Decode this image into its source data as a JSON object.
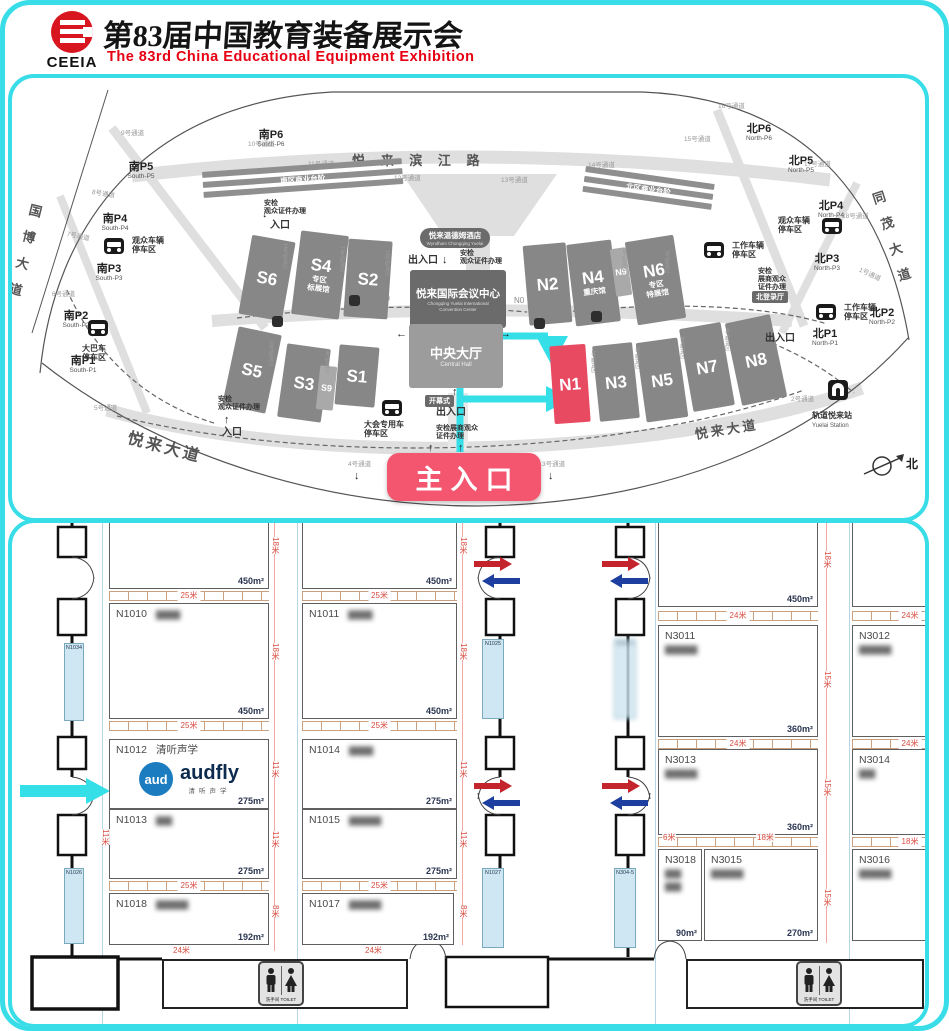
{
  "header": {
    "logo": "CEEIA",
    "title_cn": "第83届中国教育装备展示会",
    "title_en": "The 83rd China  Educational  Equipment  Exhibition"
  },
  "map": {
    "main_entrance": "主入口",
    "compass": "北",
    "center": {
      "hotel": "悦来温德姆酒店",
      "hotel_en": "Wyndham Chongqing Yuelai",
      "conv": "悦来国际会议中心",
      "conv_en": "Chongqing Yuelai International\nConvention Center",
      "hall": "中央大厅",
      "hall_en": "Central Hall"
    },
    "halls": [
      {
        "id": "S6",
        "x": 233,
        "y": 160,
        "w": 44,
        "h": 80,
        "r": 10
      },
      {
        "id": "S4",
        "x": 284,
        "y": 155,
        "w": 48,
        "h": 84,
        "r": 7,
        "sub": "专区\n标展馆"
      },
      {
        "id": "S2",
        "x": 334,
        "y": 162,
        "w": 44,
        "h": 78,
        "r": 4
      },
      {
        "id": "S5",
        "x": 218,
        "y": 252,
        "w": 44,
        "h": 80,
        "r": 12
      },
      {
        "id": "S3",
        "x": 270,
        "y": 268,
        "w": 44,
        "h": 74,
        "r": 8
      },
      {
        "id": "S9",
        "x": 306,
        "y": 288,
        "w": 17,
        "h": 44,
        "r": 6,
        "sm": 1
      },
      {
        "id": "S1",
        "x": 325,
        "y": 268,
        "w": 40,
        "h": 60,
        "r": 5
      },
      {
        "id": "N2",
        "x": 514,
        "y": 166,
        "w": 43,
        "h": 80,
        "r": -5
      },
      {
        "id": "N4",
        "x": 559,
        "y": 164,
        "w": 45,
        "h": 82,
        "r": -7,
        "sub": "重庆馆"
      },
      {
        "id": "N9",
        "x": 601,
        "y": 170,
        "w": 16,
        "h": 48,
        "r": -8,
        "sm": 1
      },
      {
        "id": "N6",
        "x": 619,
        "y": 160,
        "w": 49,
        "h": 84,
        "r": -9,
        "sub": "专区\n特展馆"
      },
      {
        "id": "N1",
        "x": 540,
        "y": 267,
        "w": 36,
        "h": 78,
        "r": -4,
        "hl": 1
      },
      {
        "id": "N3",
        "x": 584,
        "y": 266,
        "w": 40,
        "h": 76,
        "r": -6
      },
      {
        "id": "N5",
        "x": 629,
        "y": 262,
        "w": 42,
        "h": 80,
        "r": -8
      },
      {
        "id": "N7",
        "x": 674,
        "y": 247,
        "w": 42,
        "h": 84,
        "r": -10
      },
      {
        "id": "N8",
        "x": 721,
        "y": 240,
        "w": 46,
        "h": 84,
        "r": -12
      }
    ],
    "parkings": [
      {
        "cn": "南P6",
        "en": "South-P6",
        "x": 236,
        "y": 52
      },
      {
        "cn": "南P5",
        "en": "South-P5",
        "x": 106,
        "y": 84
      },
      {
        "cn": "南P4",
        "en": "South-P4",
        "x": 80,
        "y": 136
      },
      {
        "cn": "南P3",
        "en": "South-P3",
        "x": 74,
        "y": 186
      },
      {
        "cn": "南P2",
        "en": "South-P2",
        "x": 41,
        "y": 233
      },
      {
        "cn": "南P1",
        "en": "South-P1",
        "x": 48,
        "y": 278
      },
      {
        "cn": "北P6",
        "en": "North-P6",
        "x": 724,
        "y": 46
      },
      {
        "cn": "北P5",
        "en": "North-P5",
        "x": 766,
        "y": 78
      },
      {
        "cn": "北P4",
        "en": "North-P4",
        "x": 796,
        "y": 123
      },
      {
        "cn": "北P3",
        "en": "North-P3",
        "x": 792,
        "y": 176
      },
      {
        "cn": "北P2",
        "en": "North-P2",
        "x": 847,
        "y": 230
      },
      {
        "cn": "北P1",
        "en": "North-P1",
        "x": 790,
        "y": 251
      }
    ],
    "channels": [
      {
        "t": "9号通道",
        "x": 109,
        "y": 49
      },
      {
        "t": "10号通道",
        "x": 236,
        "y": 60
      },
      {
        "t": "11号通道",
        "x": 296,
        "y": 80
      },
      {
        "t": "12号通道",
        "x": 382,
        "y": 94
      },
      {
        "t": "13号通道",
        "x": 489,
        "y": 96
      },
      {
        "t": "14号通道",
        "x": 576,
        "y": 81
      },
      {
        "t": "15号通道",
        "x": 672,
        "y": 55
      },
      {
        "t": "16号通道",
        "x": 706,
        "y": 22
      },
      {
        "t": "17号通道",
        "x": 792,
        "y": 80
      },
      {
        "t": "18号通道",
        "x": 830,
        "y": 132
      },
      {
        "t": "1号通道",
        "x": 850,
        "y": 186,
        "r": 25
      },
      {
        "t": "2号通道",
        "x": 779,
        "y": 315
      },
      {
        "t": "3号通道",
        "x": 530,
        "y": 380
      },
      {
        "t": "4号通道",
        "x": 336,
        "y": 380
      },
      {
        "t": "5号通道",
        "x": 82,
        "y": 324
      },
      {
        "t": "6号通道",
        "x": 40,
        "y": 210
      },
      {
        "t": "7号通道",
        "x": 56,
        "y": 150,
        "r": 12
      },
      {
        "t": "8号通道",
        "x": 81,
        "y": 108,
        "r": 10
      }
    ],
    "unloads": [
      {
        "t": "14号卸货区",
        "x": 270,
        "y": 165
      },
      {
        "t": "13号卸货区",
        "x": 327,
        "y": 168
      },
      {
        "t": "12号卸货区",
        "x": 372,
        "y": 172
      },
      {
        "t": "10号卸货区",
        "x": 256,
        "y": 262
      },
      {
        "t": "9号卸货区",
        "x": 312,
        "y": 272
      },
      {
        "t": "5号卸货区",
        "x": 609,
        "y": 170
      },
      {
        "t": "7号卸货区",
        "x": 652,
        "y": 172
      },
      {
        "t": "1号卸货区",
        "x": 578,
        "y": 272
      },
      {
        "t": "2号卸货区",
        "x": 622,
        "y": 268
      },
      {
        "t": "3号卸货区",
        "x": 667,
        "y": 258
      },
      {
        "t": "4号卸货区",
        "x": 712,
        "y": 250
      }
    ],
    "texts": [
      {
        "t": "悦 来 滨 江 路",
        "x": 340,
        "y": 76,
        "cls": "s13 bold roadlbl sp6",
        "name": "road-yuelai-binjiang"
      },
      {
        "t": "国博大道",
        "x": 16,
        "y": 124,
        "cls": "s13 bold roadlbl vert",
        "r": 14,
        "name": "road-guobo-avenue"
      },
      {
        "t": "同茂大道",
        "x": 856,
        "y": 116,
        "cls": "s13 bold roadlbl vert",
        "r": -18,
        "name": "road-tongmao-avenue"
      },
      {
        "t": "悦来大道",
        "x": 118,
        "y": 352,
        "cls": "s16 bold roadlbl sp3",
        "r": 15,
        "name": "road-yuelai-avenue-west"
      },
      {
        "t": "悦来大道",
        "x": 682,
        "y": 350,
        "cls": "s13 bold roadlbl sp3",
        "r": -9,
        "name": "road-yuelai-avenue-east"
      },
      {
        "t": "出入口",
        "x": 396,
        "y": 177,
        "cls": "s10 bold",
        "name": "gate-label"
      },
      {
        "t": "安检\n观众证件办理",
        "x": 448,
        "y": 172,
        "cls": "s7 bold",
        "name": "security-label"
      },
      {
        "t": "出入口",
        "x": 424,
        "y": 329,
        "cls": "s10 bold",
        "name": "gate-label"
      },
      {
        "t": "安检展商观众\n证件办理",
        "x": 424,
        "y": 347,
        "cls": "s7 bold",
        "name": "security-label"
      },
      {
        "t": "安检\n观众证件办理",
        "x": 252,
        "y": 122,
        "cls": "s7 bold",
        "name": "security-label"
      },
      {
        "t": "入口",
        "x": 258,
        "y": 142,
        "cls": "s10 bold",
        "name": "entrance-label"
      },
      {
        "t": "安检\n观众证件办理",
        "x": 206,
        "y": 318,
        "cls": "s7 bold",
        "name": "security-label"
      },
      {
        "t": "入口",
        "x": 210,
        "y": 349,
        "cls": "s10 bold",
        "name": "entrance-label"
      },
      {
        "t": "安检\n展商观众\n证件办理",
        "x": 746,
        "y": 190,
        "cls": "s7 bold",
        "name": "security-label"
      },
      {
        "t": "出入口",
        "x": 753,
        "y": 255,
        "cls": "s10 bold",
        "name": "gate-label"
      },
      {
        "t": "S0",
        "x": 368,
        "y": 216,
        "cls": "s8 gray",
        "name": "hall-s0-label"
      },
      {
        "t": "N0",
        "x": 502,
        "y": 218,
        "cls": "s8 gray",
        "name": "hall-n0-label"
      }
    ],
    "tags": [
      {
        "t": "开幕式",
        "x": 413,
        "y": 317,
        "name": "opening-ceremony-tag"
      },
      {
        "t": "北登录厅",
        "x": 740,
        "y": 213,
        "name": "north-login-hall-tag"
      }
    ],
    "arrows": [
      {
        "t": "↓",
        "x": 438,
        "y": 148
      },
      {
        "t": "↓",
        "x": 430,
        "y": 176
      },
      {
        "t": "←",
        "x": 384,
        "y": 250
      },
      {
        "t": "→",
        "x": 488,
        "y": 250
      },
      {
        "t": "↑",
        "x": 440,
        "y": 308
      },
      {
        "t": "↑",
        "x": 416,
        "y": 364
      },
      {
        "t": "↑",
        "x": 446,
        "y": 364
      },
      {
        "t": "↑",
        "x": 212,
        "y": 336
      },
      {
        "t": "↓",
        "x": 250,
        "y": 130
      },
      {
        "t": "↓",
        "x": 342,
        "y": 392
      },
      {
        "t": "↓",
        "x": 536,
        "y": 392
      }
    ],
    "facilities": [
      {
        "icon": "bus",
        "t": "观众车辆\n停车区",
        "ix": 92,
        "iy": 160,
        "lx": 120,
        "ly": 158
      },
      {
        "icon": "bus",
        "t": "大巴车\n停车区",
        "ix": 76,
        "iy": 242,
        "lx": 70,
        "ly": 266
      },
      {
        "icon": "bus",
        "t": "大会专用车\n停车区",
        "ix": 370,
        "iy": 322,
        "lx": 352,
        "ly": 342
      },
      {
        "icon": "bus",
        "t": "工作车辆\n停车区",
        "ix": 692,
        "iy": 164,
        "lx": 720,
        "ly": 163
      },
      {
        "icon": "bus",
        "t": "观众车辆\n停车区",
        "ix": 810,
        "iy": 140,
        "lx": 766,
        "ly": 138
      },
      {
        "icon": "bus",
        "t": "工作车辆\n停车区",
        "ix": 804,
        "iy": 226,
        "lx": 832,
        "ly": 225
      },
      {
        "icon": "train",
        "t": "轨道悦来站",
        "en": "Yuelai Station",
        "ix": 816,
        "iy": 302,
        "lx": 800,
        "ly": 333
      }
    ],
    "bars": {
      "south": {
        "label": "南区商业台阶",
        "x": 190,
        "y": 94,
        "w": 200,
        "r": -4
      },
      "north": {
        "label": "北区商业台阶",
        "x": 574,
        "y": 88,
        "w": 130,
        "r": 8
      }
    },
    "shuttles": [
      {
        "x": 260,
        "y": 238
      },
      {
        "x": 337,
        "y": 217
      },
      {
        "x": 522,
        "y": 240
      },
      {
        "x": 579,
        "y": 233
      }
    ]
  },
  "plan": {
    "toilet_label": "洗手间 TOILET",
    "audfly": {
      "circle": "aud",
      "brand": "audfly",
      "sub": "清听声学"
    },
    "booths": [
      {
        "id": "",
        "name": "",
        "area": "450m²",
        "x": 97,
        "y": 0,
        "w": 160,
        "h": 66,
        "cut": 1
      },
      {
        "id": "N1010",
        "name": "▆▆▆",
        "blur": 1,
        "area": "450m²",
        "x": 97,
        "y": 80,
        "w": 160,
        "h": 116
      },
      {
        "id": "N1012",
        "name": "清听声学",
        "area": "275m²",
        "x": 97,
        "y": 216,
        "w": 160,
        "h": 70,
        "logo": 1
      },
      {
        "id": "N1013",
        "name": "▆▆",
        "blur": 1,
        "area": "275m²",
        "x": 97,
        "y": 286,
        "w": 160,
        "h": 70
      },
      {
        "id": "N1018",
        "name": "▆▆▆▆",
        "blur": 1,
        "area": "192m²",
        "x": 97,
        "y": 370,
        "w": 160,
        "h": 52
      },
      {
        "id": "",
        "name": "",
        "area": "450m²",
        "x": 290,
        "y": 0,
        "w": 155,
        "h": 66,
        "cut": 1
      },
      {
        "id": "N1011",
        "name": "▆▆▆",
        "blur": 1,
        "area": "450m²",
        "x": 290,
        "y": 80,
        "w": 155,
        "h": 116
      },
      {
        "id": "N1014",
        "name": "▆▆▆",
        "blur": 1,
        "area": "275m²",
        "x": 290,
        "y": 216,
        "w": 155,
        "h": 70
      },
      {
        "id": "N1015",
        "name": "▆▆▆▆",
        "blur": 1,
        "area": "275m²",
        "x": 290,
        "y": 286,
        "w": 155,
        "h": 70
      },
      {
        "id": "N1017",
        "name": "▆▆▆▆",
        "blur": 1,
        "area": "192m²",
        "x": 290,
        "y": 370,
        "w": 152,
        "h": 52
      },
      {
        "id": "",
        "name": "",
        "area": "450m²",
        "x": 646,
        "y": 0,
        "w": 160,
        "h": 84,
        "cut": 1
      },
      {
        "id": "N3011",
        "name": "▆▆▆▆",
        "blur": 1,
        "two": 1,
        "area": "360m²",
        "x": 646,
        "y": 102,
        "w": 160,
        "h": 112
      },
      {
        "id": "N3013",
        "name": "▆▆▆▆",
        "blur": 1,
        "two": 1,
        "area": "360m²",
        "x": 646,
        "y": 226,
        "w": 160,
        "h": 86
      },
      {
        "id": "N3018",
        "name": "▆▆\n▆▆",
        "blur": 1,
        "two": 1,
        "area": "90m²",
        "x": 646,
        "y": 326,
        "w": 44,
        "h": 92
      },
      {
        "id": "N3015",
        "name": "▆▆▆▆",
        "blur": 1,
        "two": 1,
        "area": "270m²",
        "x": 692,
        "y": 326,
        "w": 114,
        "h": 92
      },
      {
        "id": "",
        "name": "",
        "area": "",
        "x": 840,
        "y": 0,
        "w": 116,
        "h": 84,
        "cut": 1
      },
      {
        "id": "N3012",
        "name": "▆▆▆▆",
        "blur": 1,
        "two": 1,
        "area": "",
        "x": 840,
        "y": 102,
        "w": 116,
        "h": 112
      },
      {
        "id": "N3014",
        "name": "▆▆",
        "blur": 1,
        "two": 1,
        "area": "",
        "x": 840,
        "y": 226,
        "w": 116,
        "h": 86
      },
      {
        "id": "N3016",
        "name": "▆▆▆▆",
        "blur": 1,
        "two": 1,
        "area": "",
        "x": 840,
        "y": 326,
        "w": 116,
        "h": 92
      }
    ],
    "wall_booths": [
      {
        "id": "N1034",
        "x": 52,
        "y": 120,
        "w": 20,
        "h": 78
      },
      {
        "id": "N1026",
        "x": 52,
        "y": 345,
        "w": 20,
        "h": 76
      },
      {
        "id": "N1025",
        "x": 470,
        "y": 116,
        "w": 22,
        "h": 80
      },
      {
        "id": "N1027",
        "x": 470,
        "y": 345,
        "w": 22,
        "h": 80
      },
      {
        "id": "N304-4",
        "x": 602,
        "y": 116,
        "w": 22,
        "h": 80,
        "blur": 1
      },
      {
        "id": "N304-5",
        "x": 602,
        "y": 345,
        "w": 22,
        "h": 80
      }
    ],
    "ticks": [
      {
        "x": 97,
        "y": 68,
        "w": 160,
        "t": "25米"
      },
      {
        "x": 290,
        "y": 68,
        "w": 155,
        "t": "25米"
      },
      {
        "x": 97,
        "y": 198,
        "w": 160,
        "t": "25米"
      },
      {
        "x": 290,
        "y": 198,
        "w": 155,
        "t": "25米"
      },
      {
        "x": 97,
        "y": 358,
        "w": 160,
        "t": "25米"
      },
      {
        "x": 290,
        "y": 358,
        "w": 155,
        "t": "25米"
      },
      {
        "x": 646,
        "y": 88,
        "w": 160,
        "t": "24米"
      },
      {
        "x": 840,
        "y": 88,
        "w": 116,
        "t": "24米"
      },
      {
        "x": 646,
        "y": 216,
        "w": 160,
        "t": "24米"
      },
      {
        "x": 840,
        "y": 216,
        "w": 116,
        "t": "24米"
      },
      {
        "x": 646,
        "y": 314,
        "w": 160
      },
      {
        "x": 840,
        "y": 314,
        "w": 116,
        "t": "18米"
      }
    ],
    "dims": [
      {
        "t": "18米",
        "x": 258,
        "y": 14,
        "v": 1
      },
      {
        "t": "18米",
        "x": 446,
        "y": 14,
        "v": 1
      },
      {
        "t": "18米",
        "x": 258,
        "y": 120,
        "v": 1
      },
      {
        "t": "18米",
        "x": 446,
        "y": 120,
        "v": 1
      },
      {
        "t": "11米",
        "x": 258,
        "y": 238,
        "v": 1
      },
      {
        "t": "11米",
        "x": 446,
        "y": 238,
        "v": 1
      },
      {
        "t": "11米",
        "x": 88,
        "y": 306,
        "v": 1
      },
      {
        "t": "11米",
        "x": 258,
        "y": 308,
        "v": 1
      },
      {
        "t": "11米",
        "x": 446,
        "y": 308,
        "v": 1
      },
      {
        "t": "8米",
        "x": 258,
        "y": 382,
        "v": 1
      },
      {
        "t": "8米",
        "x": 446,
        "y": 382,
        "v": 1
      },
      {
        "t": "24米",
        "x": 160,
        "y": 424
      },
      {
        "t": "24米",
        "x": 352,
        "y": 424
      },
      {
        "t": "6米",
        "x": 650,
        "y": 311
      },
      {
        "t": "18米",
        "x": 744,
        "y": 311
      },
      {
        "t": "18米",
        "x": 810,
        "y": 28,
        "v": 1
      },
      {
        "t": "15米",
        "x": 810,
        "y": 148,
        "v": 1
      },
      {
        "t": "15米",
        "x": 810,
        "y": 256,
        "v": 1
      },
      {
        "t": "15米",
        "x": 810,
        "y": 366,
        "v": 1
      }
    ],
    "vguides": [
      90,
      285,
      643,
      837
    ],
    "plines": [
      {
        "x": 262,
        "y": 0,
        "h": 428
      },
      {
        "x": 450,
        "y": 0,
        "h": 422
      },
      {
        "x": 814,
        "y": 0,
        "h": 420
      }
    ],
    "toilets": [
      {
        "x": 150,
        "y": 436,
        "w": 246,
        "h": 50,
        "px": 96
      },
      {
        "x": 674,
        "y": 436,
        "w": 238,
        "h": 50,
        "px": 110
      }
    ]
  }
}
